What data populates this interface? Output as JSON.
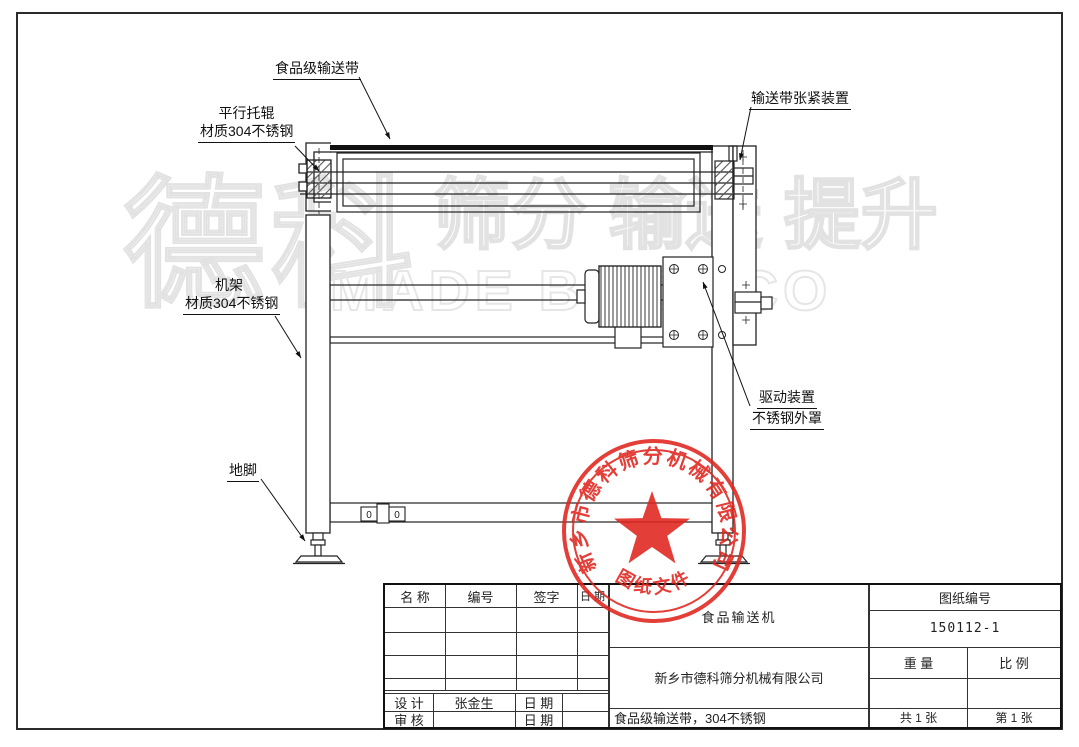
{
  "watermark": {
    "big": "德科",
    "mid": "筛分 输送 提升",
    "eng": "MADE BY DECO"
  },
  "callouts": {
    "belt": "食品级输送带",
    "roller_line1": "平行托辊",
    "roller_line2": "材质304不锈钢",
    "tension": "输送带张紧装置",
    "frame_line1": "机架",
    "frame_line2": "材质304不锈钢",
    "drive_line1": "驱动装置",
    "drive_line2": "不锈钢外罩",
    "foot": "地脚"
  },
  "machine": {
    "hole_marks": [
      "0",
      "0"
    ]
  },
  "stamp": {
    "company_arc": "新乡市德科筛分机械有限公司",
    "bottom_text": "图纸文件",
    "color": "#e0241d"
  },
  "title_block": {
    "headers": {
      "name": "名 称",
      "number": "编号",
      "signature": "签字",
      "date": "日 期"
    },
    "design_label": "设 计",
    "design_name": "张金生",
    "design_date_label": "日 期",
    "audit_label": "审 核",
    "audit_date_label": "日 期",
    "product_name": "食品输送机",
    "company": "新乡市德科筛分机械有限公司",
    "description": "食品级输送带，304不锈钢",
    "drawing_no_label": "图纸编号",
    "drawing_no": "150112-1",
    "weight_label": "重 量",
    "scale_label": "比 例",
    "sheet_total": "共 1 张",
    "sheet_no": "第 1 张"
  }
}
